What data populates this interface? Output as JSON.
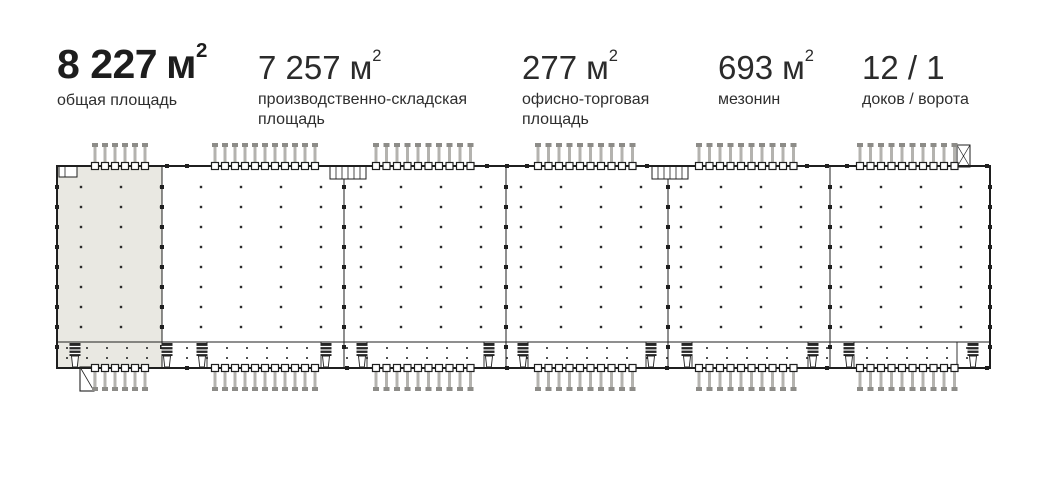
{
  "stats": [
    {
      "value": "8 227",
      "unit": "м",
      "sup": "2",
      "label": "общая площадь"
    },
    {
      "value": "7 257",
      "unit": "м",
      "sup": "2",
      "label": "производственно-складская площадь"
    },
    {
      "value": "277",
      "unit": "м",
      "sup": "2",
      "label": "офисно-торговая площадь"
    },
    {
      "value": "693",
      "unit": "м",
      "sup": "2",
      "label": "мезонин"
    },
    {
      "value": "12 / 1",
      "unit": "",
      "sup": "",
      "label": "доков / ворота"
    }
  ],
  "plan": {
    "outline": {
      "x": 57,
      "y": 166,
      "w": 933,
      "h": 202
    },
    "shaded_section": {
      "x": 57,
      "y": 166,
      "w": 105,
      "h": 202
    },
    "dividers_x": [
      162,
      344,
      506,
      668,
      830
    ],
    "mezzanine_line_y": 342,
    "column_grid": {
      "x0": 81,
      "x_step": 40,
      "cols": 23,
      "y0": 187,
      "y_step": 20,
      "rows": 8,
      "dot": 2.4
    },
    "mezz_dots": {
      "x0": 67,
      "x_step": 20,
      "count": 46,
      "rows_y": [
        348,
        358
      ],
      "dot": 1.8
    },
    "pile_groups": [
      {
        "x0": 95,
        "n": 6,
        "step": 10
      },
      {
        "x0": 215,
        "n": 11,
        "step": 10
      },
      {
        "x0": 376,
        "n": 10,
        "step": 10.5
      },
      {
        "x0": 538,
        "n": 10,
        "step": 10.5
      },
      {
        "x0": 699,
        "n": 10,
        "step": 10.5
      },
      {
        "x0": 860,
        "n": 10,
        "step": 10.5
      }
    ],
    "docks_x": [
      75,
      167,
      202,
      326,
      362,
      489,
      523,
      651,
      687,
      813,
      849,
      973
    ],
    "dock_bays": [
      [
        162,
        207
      ],
      [
        321,
        367
      ],
      [
        484,
        528
      ],
      [
        646,
        692
      ],
      [
        808,
        854
      ],
      [
        957,
        990
      ]
    ],
    "gate": {
      "x": 80,
      "y": 367,
      "w": 14,
      "h": 24
    },
    "stairs": [
      {
        "x": 330,
        "y": 166,
        "w": 36,
        "h": 13
      },
      {
        "x": 652,
        "y": 166,
        "w": 36,
        "h": 13
      }
    ],
    "ramp_box": {
      "x": 957,
      "y": 145,
      "w": 13,
      "h": 22
    },
    "entry_door": {
      "x": 59,
      "y": 166,
      "w": 18,
      "h": 11
    },
    "colors": {
      "wall": "#1f1f1f",
      "dot": "#2b2b2b",
      "shade": "#e9e8e2",
      "pile_bar": "#b4b3af",
      "pile_cap": "#8d8c88",
      "dock": "#262626"
    }
  }
}
